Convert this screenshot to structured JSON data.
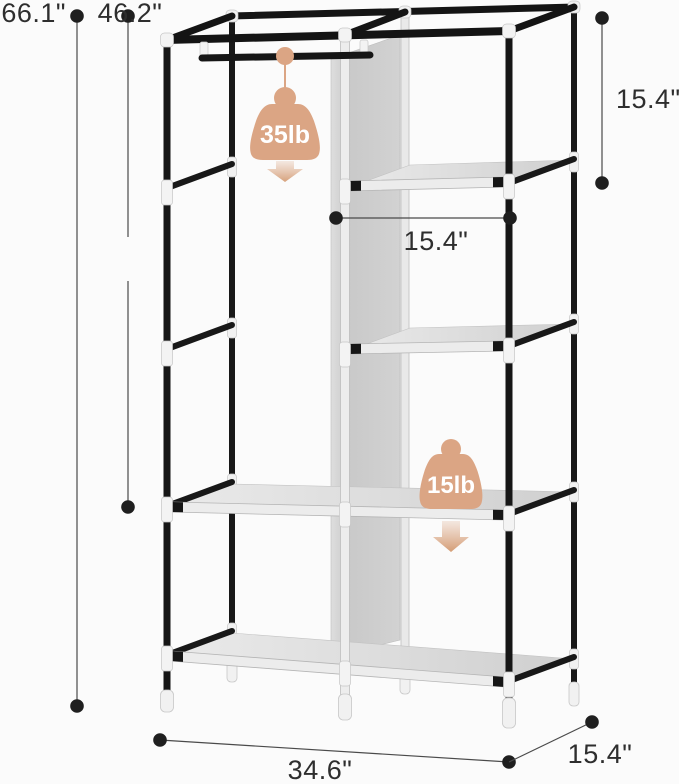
{
  "diagram": {
    "subject": "garment-rack-dimension-diagram"
  },
  "dimensions": {
    "total_height": "66.1\"",
    "hanging_section_height": "46.2\"",
    "top_section_height": "15.4\"",
    "shelf_column_width": "15.4\"",
    "total_width": "34.6\"",
    "depth": "15.4\""
  },
  "capacities": {
    "hanging_rod": "35lb",
    "shelf": "15lb"
  },
  "icons": {
    "weight": "weight-icon",
    "down_arrow": "down-arrow-icon",
    "measure_dot": "dimension-endpoint-dot"
  },
  "colors": {
    "weight_accent": "#dba584",
    "dimension_ink": "#3d3d3d",
    "dot_ink": "#1f1f1f",
    "tube_black": "#161616",
    "rail_silver": "#ececec",
    "fabric_gray": "#d9d9d9",
    "panel_gray": "#c9c9c9",
    "connector_white": "#f3f3f3",
    "background": "#fbfbfb"
  }
}
